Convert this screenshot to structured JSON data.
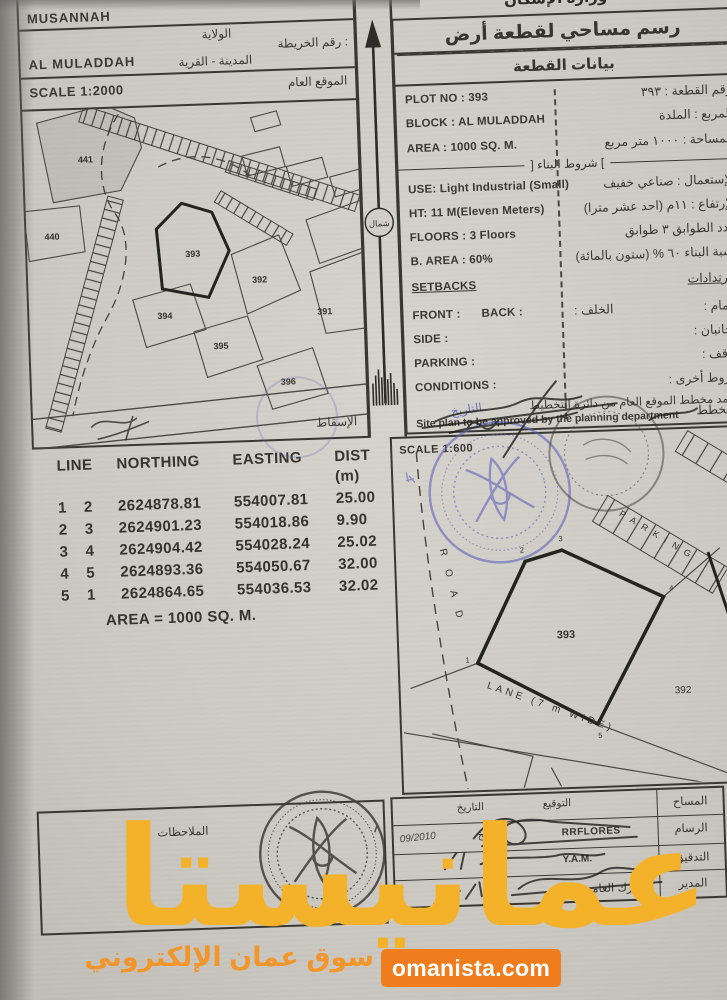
{
  "location_panel": {
    "serial_no_label": "الرقم المسلسل",
    "wilaya_value": "MUSANNAH",
    "wilaya_label": "الولاية",
    "map_no_label": "رقم الخريطة :",
    "city_village_label": "المدينة - القرية",
    "city_value": "AL MULADDAH",
    "scale_text": "SCALE 1:2000",
    "general_site_label": "الموقع العام",
    "projection_label": "الإسقاط",
    "plots": {
      "p441": "441",
      "p440": "440",
      "p393": "393",
      "p392": "392",
      "p391": "391",
      "p394": "394",
      "p395": "395",
      "p396": "396"
    }
  },
  "north_arrow": {
    "label": "شمال"
  },
  "plot_data_panel": {
    "clipped_ministry_header": "وزارة الإسكان",
    "title": "رسم مساحي لقطعة أرض",
    "subtitle": "بيانات القطعة",
    "en": {
      "plot_no": "PLOT NO : 393",
      "block": "BLOCK :  AL MULADDAH",
      "area": "AREA :  1000 SQ. M.",
      "use": "USE: Light Industrial (Small)",
      "height": "HT: 11 M(Eleven Meters)",
      "floors": "FLOORS : 3 Floors",
      "built_area": "B. AREA :   60%",
      "setbacks": "SETBACKS",
      "front": "FRONT :",
      "back": "BACK :",
      "side": "SIDE :",
      "parking": "PARKING :",
      "conditions": "CONDITIONS :",
      "approval_note": "Site plan to be approved by the planning department"
    },
    "ar": {
      "plot_no": "رقم القطعة : ٣٩٣",
      "block": "المربع : الملدة",
      "area": "المساحة : ١٠٠٠ متر مربع",
      "building_conditions_header": "] شروط البناء [",
      "use": "الإستعمال : صناعي خفيف",
      "height": "الإرتفاع : ١١م (احد عشر مترا)",
      "floors": "عدد الطوابق ٣ طوابق",
      "built_area": "نسبة البناء ٦٠ % (ستون بالمائة)",
      "setbacks": "الإرتدادات",
      "front": "الأمام :",
      "back": "الخلف :",
      "side": "الجانبان :",
      "parking": "موقف :",
      "conditions": "شروط أخرى :",
      "approval_note": "إعتمد مخطط الموقع العام من دائرة التخطيط",
      "planner_label": "المخطط",
      "date_label": "التاريخ"
    }
  },
  "coordinates_table": {
    "headers": {
      "line": "LINE",
      "northing": "NORTHING",
      "easting": "EASTING",
      "dist": "DIST (m)"
    },
    "rows": [
      [
        "1",
        "2",
        "2624878.81",
        "554007.81",
        "25.00"
      ],
      [
        "2",
        "3",
        "2624901.23",
        "554018.86",
        "9.90"
      ],
      [
        "3",
        "4",
        "2624904.42",
        "554028.24",
        "25.02"
      ],
      [
        "4",
        "5",
        "2624893.36",
        "554050.67",
        "32.00"
      ],
      [
        "5",
        "1",
        "2624864.65",
        "554036.53",
        "32.02"
      ]
    ],
    "area_text": "AREA = 1000 SQ. M."
  },
  "site_plan_panel": {
    "scale_text": "SCALE 1:600",
    "plot_no": "393",
    "neighbor_plot": "392",
    "road_label": "ROAD",
    "lane_label": "LANE (7 m WIDE)",
    "parking_label": "PARKING",
    "vertices": [
      "1",
      "2",
      "3",
      "4",
      "5"
    ]
  },
  "signature_panel": {
    "col_signature": "التوقيع",
    "col_date": "التاريخ",
    "rows": [
      {
        "label": "المساح",
        "value": "",
        "date": ""
      },
      {
        "label": "الرسام",
        "value": "RRFLORES",
        "date": "09/2010",
        "inline_date_label": "التاريخ"
      },
      {
        "label": "التدقيق",
        "value": "Y.A.M.",
        "date": ""
      },
      {
        "label": "المدير",
        "value": "مبارك العامري",
        "date": ""
      }
    ]
  },
  "notes_panel": {
    "label": "الملاحظات"
  },
  "overlay": {
    "watermark_text": "عمانيستا",
    "tagline": "سوق عمان الإلكتروني",
    "website": "omanista.com"
  },
  "colors": {
    "watermark_yellow": "#f3b229",
    "tagline_orange": "#f2952a",
    "button_orange": "#ef7d1e",
    "stamp_blue": "#5d63bb",
    "ink": "#37352f"
  }
}
